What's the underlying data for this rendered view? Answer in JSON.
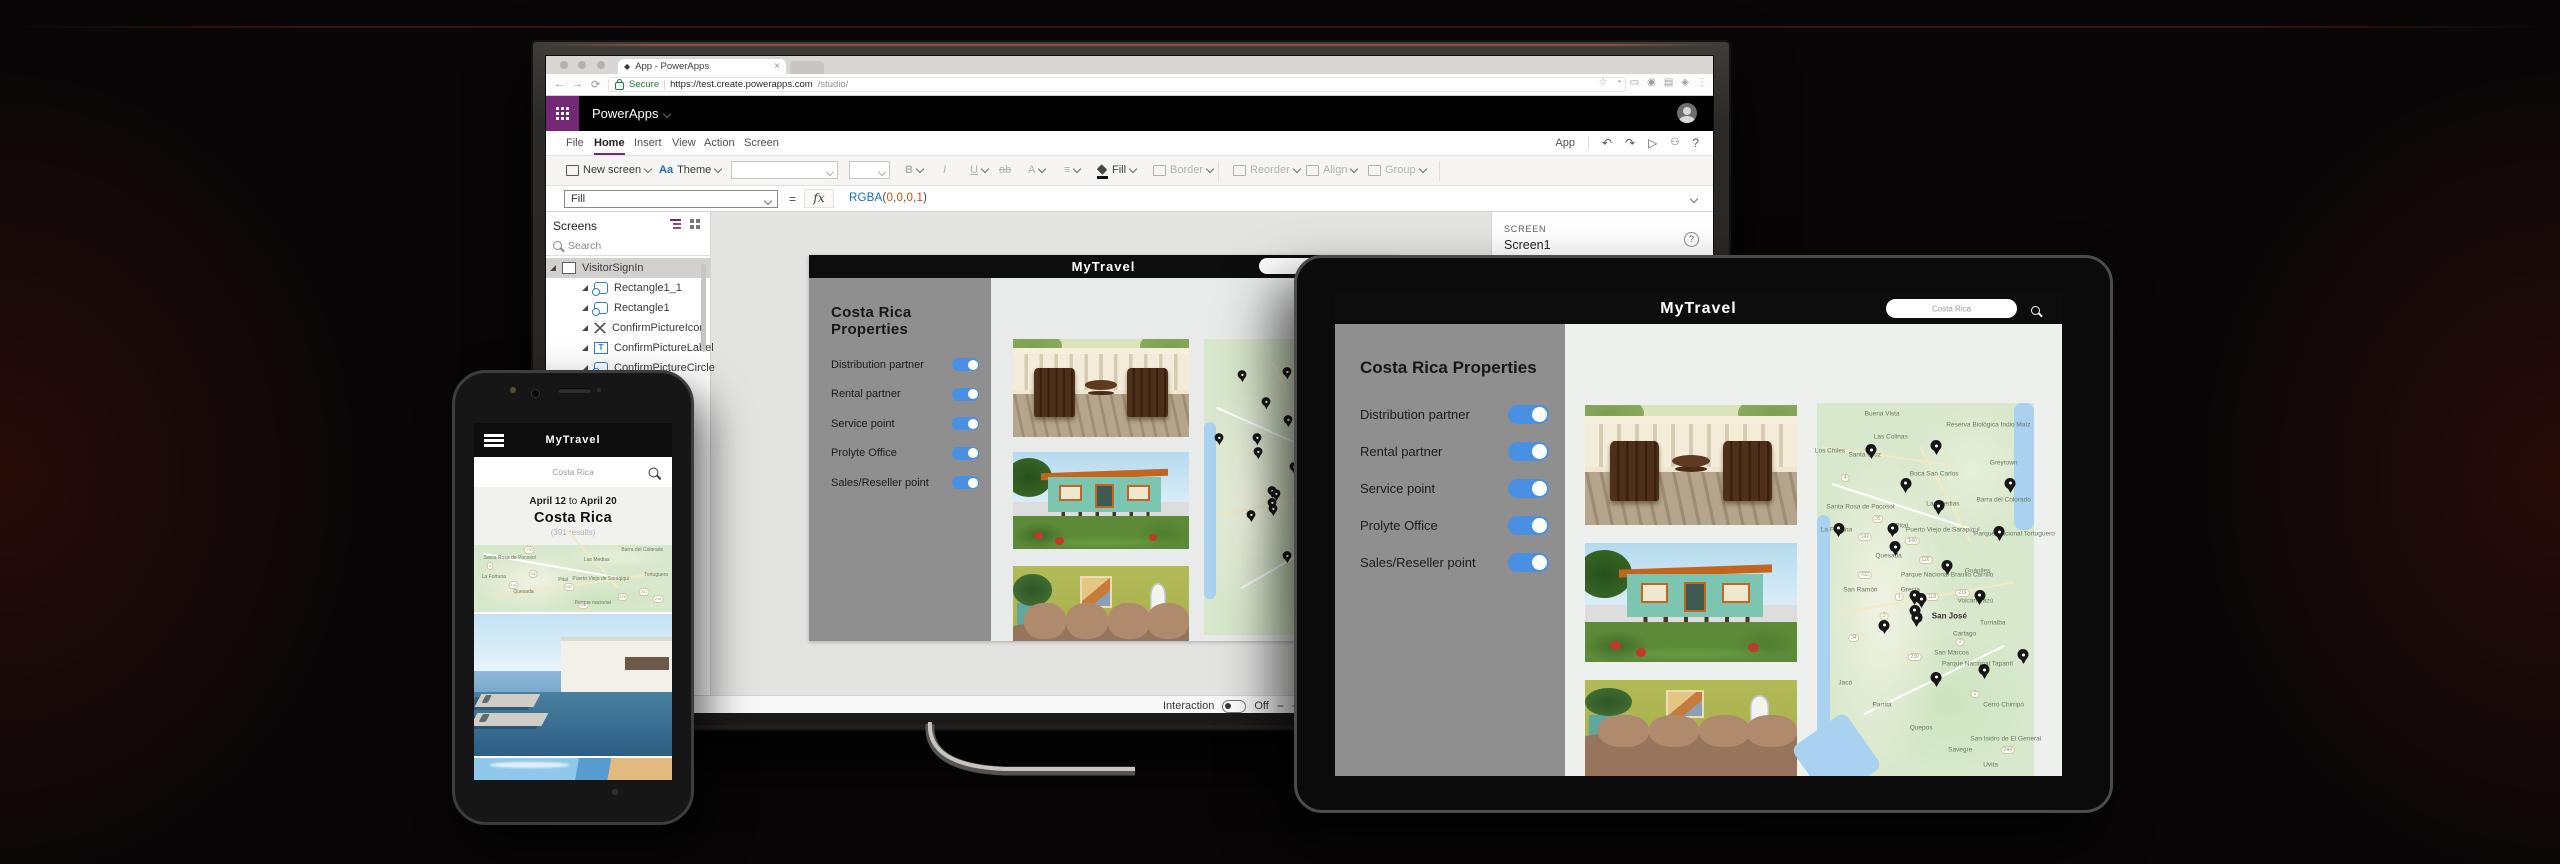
{
  "colors": {
    "accent_purple": "#742774",
    "toggle_blue": "#4a90e2",
    "secure_green": "#178038",
    "formula_fn": "#0b6fc2",
    "formula_num": "#c75300"
  },
  "icons": {
    "back": "←",
    "forward": "→",
    "refresh": "⟳",
    "star": "☆",
    "ext1": "◔",
    "ext2": "▭",
    "ext3": "◉",
    "ext4": "▤",
    "ext5": "◈",
    "overflow": "⋮",
    "undo": "↶",
    "redo": "↷",
    "play": "▷",
    "person": "☻",
    "help": "?",
    "close": "×",
    "tab_favicon": "◆",
    "bold": "B",
    "italic": "I",
    "underline": "U",
    "strike": "ab",
    "font_color": "A",
    "theme_aa": "Aa",
    "align": "≡",
    "fx": "fx",
    "equals": "="
  },
  "browser": {
    "tab_title": "App - PowerApps",
    "secure": "Secure",
    "url_domain": "https://test.create.powerapps.com",
    "url_path": "/studio/"
  },
  "powerapps": {
    "brand": "PowerApps",
    "menu": [
      {
        "t": "File"
      },
      {
        "t": "Home",
        "cls": "active"
      },
      {
        "t": "Insert"
      },
      {
        "t": "View"
      },
      {
        "t": "Action"
      },
      {
        "t": "Screen"
      }
    ],
    "app_label": "App",
    "ribbon": {
      "new_screen": "New screen",
      "theme": "Theme",
      "fill": "Fill",
      "border": "Border",
      "reorder": "Reorder",
      "align": "Align",
      "group": "Group"
    },
    "formula": {
      "property": "Fill",
      "tokens": [
        {
          "t": "RGBA",
          "cls": "fx-fn"
        },
        {
          "t": "(",
          "cls": "fx-p"
        },
        {
          "t": "0",
          "cls": "fx-n"
        },
        {
          "t": ",",
          "cls": "fx-p"
        },
        {
          "t": "0",
          "cls": "fx-n"
        },
        {
          "t": ",",
          "cls": "fx-p"
        },
        {
          "t": "0",
          "cls": "fx-n"
        },
        {
          "t": ",",
          "cls": "fx-p"
        },
        {
          "t": "1",
          "cls": "fx-n"
        },
        {
          "t": ")",
          "cls": "fx-p"
        }
      ]
    },
    "screens_panel": {
      "title": "Screens",
      "search_placeholder": "Search",
      "items": [
        {
          "t": "VisitorSignIn",
          "type": "screen-ic",
          "cls": "root",
          "selected": true
        },
        {
          "t": "Rectangle1_1",
          "type": "shape"
        },
        {
          "t": "Rectangle1",
          "type": "shape"
        },
        {
          "t": "ConfirmPictureIcon",
          "type": "arrows"
        },
        {
          "t": "ConfirmPictureLabel",
          "type": "text"
        },
        {
          "t": "ConfirmPictureCircle",
          "type": "shape"
        }
      ]
    },
    "right_panel": {
      "kicker": "SCREEN",
      "value": "Screen1"
    },
    "status": {
      "screen": "Screen1",
      "interaction_label": "Interaction",
      "state": "Off",
      "zoom_out": "−",
      "zoom_in": "+"
    }
  },
  "app": {
    "title": "MyTravel",
    "search_placeholder": "Costa Rica",
    "heading": "Costa Rica Properties",
    "toggles": [
      "Distribution partner",
      "Rental partner",
      "Service point",
      "Prolyte Office",
      "Sales/Reseller point"
    ],
    "phone": {
      "date_from": "April 12",
      "joiner": " to ",
      "date_to": "April 20",
      "destination": "Costa Rica",
      "results": "(391 results)"
    }
  },
  "maps": {
    "labels": [
      {
        "x": 30,
        "y": 3,
        "t": "Buena Vista"
      },
      {
        "x": 34,
        "y": 9,
        "t": "Las Colinas"
      },
      {
        "x": 79,
        "y": 6,
        "t": "Reserva Biológica Indio Maíz"
      },
      {
        "x": 22,
        "y": 14,
        "t": "Santa Cruz"
      },
      {
        "x": 6,
        "y": 13,
        "t": "Los Chiles"
      },
      {
        "x": 86,
        "y": 16,
        "t": "Greytown"
      },
      {
        "x": 54,
        "y": 19,
        "t": "Boca San Carlos"
      },
      {
        "x": 86,
        "y": 26,
        "t": "Barra del Colorado"
      },
      {
        "x": 20,
        "y": 28,
        "t": "Santa Rosa de Pocosol"
      },
      {
        "x": 58,
        "y": 27,
        "t": "Las Medias"
      },
      {
        "x": 58,
        "y": 34,
        "t": "Puerto Viejo de Sarapiquí"
      },
      {
        "x": 9,
        "y": 34,
        "t": "La Fortuna"
      },
      {
        "x": 39,
        "y": 33,
        "t": "Pital"
      },
      {
        "x": 33,
        "y": 41,
        "t": "Quesada"
      },
      {
        "x": 91,
        "y": 35,
        "t": "Parque Nacional Tortuguero"
      },
      {
        "x": 20,
        "y": 50,
        "t": "San Ramón"
      },
      {
        "x": 43,
        "y": 50,
        "t": "Grecia"
      },
      {
        "x": 60,
        "y": 46,
        "t": "Parque Nacional Braulio Carrillo"
      },
      {
        "x": 74,
        "y": 45,
        "t": "Guápiles"
      },
      {
        "x": 61,
        "y": 57,
        "t": "San José",
        "cls": "big"
      },
      {
        "x": 73,
        "y": 53,
        "t": "Volcán Irazú"
      },
      {
        "x": 81,
        "y": 59,
        "t": "Turrialba"
      },
      {
        "x": 68,
        "y": 62,
        "t": "Cartago"
      },
      {
        "x": 74,
        "y": 70,
        "t": "Parque Nacional Tapantí"
      },
      {
        "x": 62,
        "y": 67,
        "t": "San Marcos"
      },
      {
        "x": 13,
        "y": 75,
        "t": "Jacó"
      },
      {
        "x": 30,
        "y": 81,
        "t": "Parrita"
      },
      {
        "x": 48,
        "y": 87,
        "t": "Quepos"
      },
      {
        "x": 86,
        "y": 81,
        "t": "Cerro Chirripó"
      },
      {
        "x": 87,
        "y": 90,
        "t": "San Isidro de El General"
      },
      {
        "x": 66,
        "y": 93,
        "t": "Savegre"
      },
      {
        "x": 80,
        "y": 97,
        "t": "Uvita"
      }
    ],
    "pins": [
      {
        "x": 25,
        "y": 14
      },
      {
        "x": 55,
        "y": 13
      },
      {
        "x": 41,
        "y": 23
      },
      {
        "x": 89,
        "y": 23
      },
      {
        "x": 56,
        "y": 29
      },
      {
        "x": 10,
        "y": 35
      },
      {
        "x": 35,
        "y": 35
      },
      {
        "x": 36,
        "y": 40
      },
      {
        "x": 84,
        "y": 36
      },
      {
        "x": 60,
        "y": 45
      },
      {
        "x": 45,
        "y": 53
      },
      {
        "x": 48,
        "y": 54
      },
      {
        "x": 45,
        "y": 57
      },
      {
        "x": 46,
        "y": 59
      },
      {
        "x": 31,
        "y": 61
      },
      {
        "x": 75,
        "y": 53
      },
      {
        "x": 95,
        "y": 69
      },
      {
        "x": 77,
        "y": 73
      },
      {
        "x": 55,
        "y": 75
      }
    ],
    "shields": [
      {
        "x": 13,
        "y": 20,
        "t": "4"
      },
      {
        "x": 28,
        "y": 31,
        "t": "35"
      },
      {
        "x": 22,
        "y": 36,
        "t": "141"
      },
      {
        "x": 44,
        "y": 37,
        "t": "140"
      },
      {
        "x": 50,
        "y": 42,
        "t": "126"
      },
      {
        "x": 22,
        "y": 46,
        "t": "702"
      },
      {
        "x": 38,
        "y": 52,
        "t": "1"
      },
      {
        "x": 53,
        "y": 52,
        "t": "118"
      },
      {
        "x": 67,
        "y": 51,
        "t": "219"
      },
      {
        "x": 31,
        "y": 57,
        "t": "3"
      },
      {
        "x": 46,
        "y": 57,
        "t": "27"
      },
      {
        "x": 17,
        "y": 63,
        "t": "34"
      },
      {
        "x": 66,
        "y": 64,
        "t": "2"
      },
      {
        "x": 45,
        "y": 68,
        "t": "239"
      },
      {
        "x": 73,
        "y": 78,
        "t": "2"
      },
      {
        "x": 88,
        "y": 93,
        "t": "244"
      }
    ],
    "phone_labels": [
      {
        "x": 18,
        "y": 20,
        "t": "Santa Rosa de Pocosol"
      },
      {
        "x": 62,
        "y": 22,
        "t": "Las Medias"
      },
      {
        "x": 85,
        "y": 8,
        "t": "Barra del Colorado"
      },
      {
        "x": 10,
        "y": 48,
        "t": "La Fortuna"
      },
      {
        "x": 45,
        "y": 52,
        "t": "Pital"
      },
      {
        "x": 64,
        "y": 50,
        "t": "Puerto Viejo de Saraqiqui"
      },
      {
        "x": 25,
        "y": 70,
        "t": "Quesada"
      },
      {
        "x": 60,
        "y": 86,
        "t": "Parque nacional"
      },
      {
        "x": 92,
        "y": 45,
        "t": "Tortuguero"
      }
    ],
    "phone_shields": [
      {
        "x": 28,
        "y": 8,
        "t": "793"
      },
      {
        "x": 8,
        "y": 32,
        "t": "4"
      },
      {
        "x": 30,
        "y": 44,
        "t": "35"
      },
      {
        "x": 20,
        "y": 60,
        "t": "141"
      },
      {
        "x": 48,
        "y": 62,
        "t": "140"
      },
      {
        "x": 55,
        "y": 90,
        "t": "126"
      },
      {
        "x": 75,
        "y": 78,
        "t": "229"
      },
      {
        "x": 86,
        "y": 70,
        "t": "247"
      },
      {
        "x": 93,
        "y": 80,
        "t": "248"
      }
    ]
  }
}
